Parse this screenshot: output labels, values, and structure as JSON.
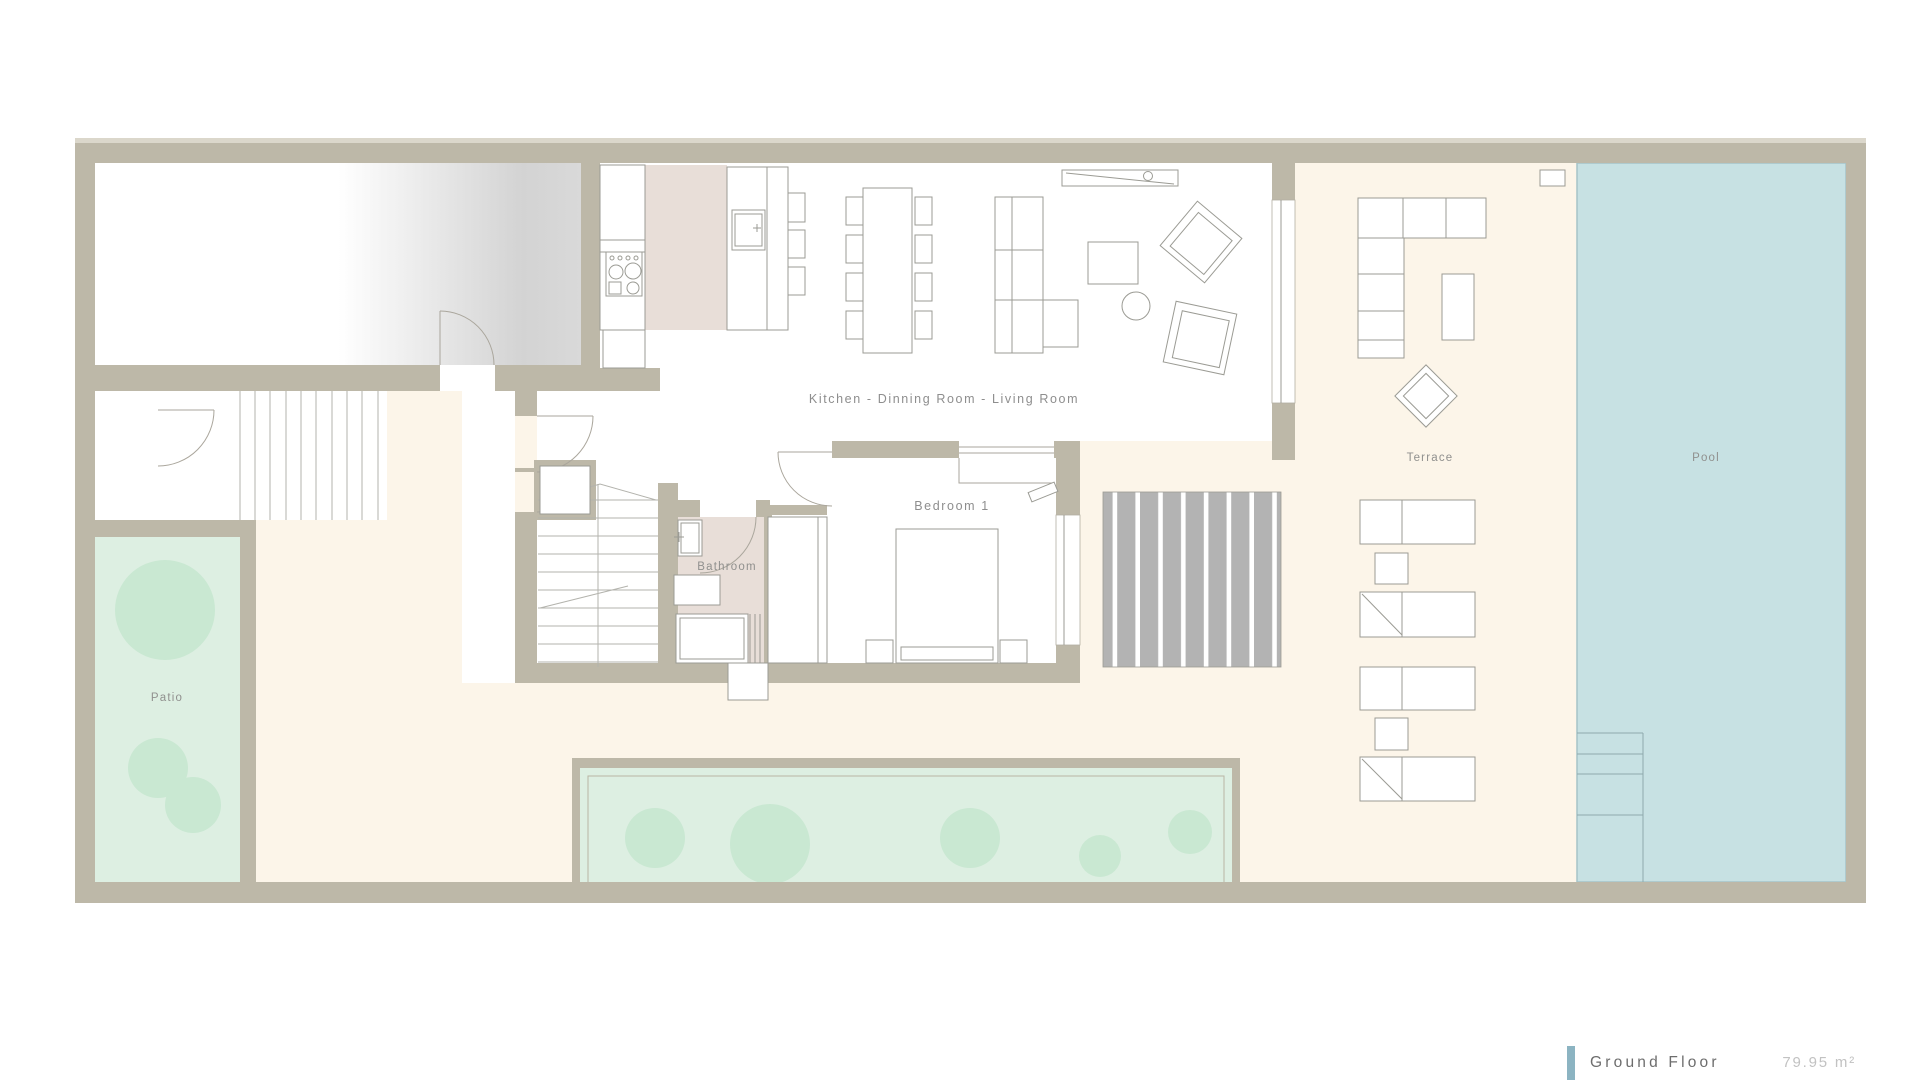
{
  "plan_type": "ground-floor-plan",
  "labels": {
    "kitchen_living": "Kitchen - Dinning Room - Living Room",
    "bedroom": "Bedroom 1",
    "bathroom": "Bathroom",
    "terrace": "Terrace",
    "pool": "Pool",
    "patio": "Patio"
  },
  "legend": {
    "rows": [
      {
        "label": "Ground Floor",
        "area": "79.95 m²",
        "clipped": false
      },
      {
        "label": "Lower Floor",
        "area": "103.46 m²",
        "clipped": true
      }
    ],
    "accent_color": "#8cb4c2"
  },
  "colors": {
    "wall": "#bdb8a8",
    "terrace_floor": "#fcf5e9",
    "pool_water": "#c7e1e3",
    "pool_edge": "#a5c3c7",
    "garden": "#ddefe2",
    "garden_bush": "#c9e8d2",
    "bathroom_floor": "#e8ded8",
    "kitchen_floor": "#e8ded8",
    "deck_slats": "#b3b3b3",
    "garage_gradient_end": "#d6d6d6",
    "room_label_text": "#8e8e8e",
    "legend_label_text": "#6d6d6d",
    "legend_value_text": "#c2c2c2"
  }
}
